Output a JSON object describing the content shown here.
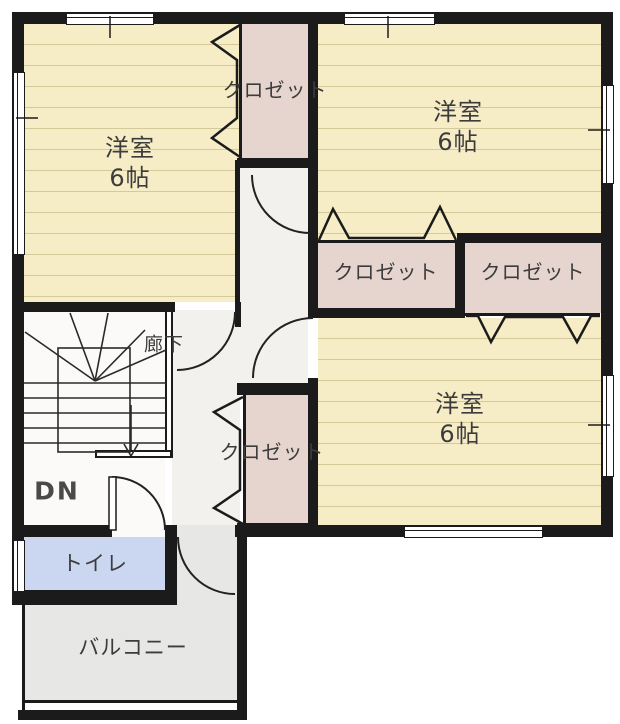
{
  "floorplan": {
    "rooms": [
      {
        "label": "洋室",
        "size": "6帖"
      },
      {
        "label": "洋室",
        "size": "6帖"
      },
      {
        "label": "洋室",
        "size": "6帖"
      }
    ],
    "closets": {
      "top_left": "クロゼット",
      "middle_left": "クロゼット",
      "middle_right": "クロゼット",
      "bottom": "クロゼット"
    },
    "hallway": {
      "label": "廊下"
    },
    "stairs": {
      "direction_label": "DN"
    },
    "toilet": {
      "label": "トイレ"
    },
    "balcony": {
      "label": "バルコニー"
    },
    "colors": {
      "wall": "#1b1b1b",
      "room_floor": "#f6edc7",
      "closet_floor": "#e6d5ce",
      "hallway_floor": "#f2f1ee",
      "toilet_floor": "#cbd7f0",
      "balcony_floor": "#e7e7e6",
      "text": "#3c3c3c"
    }
  }
}
